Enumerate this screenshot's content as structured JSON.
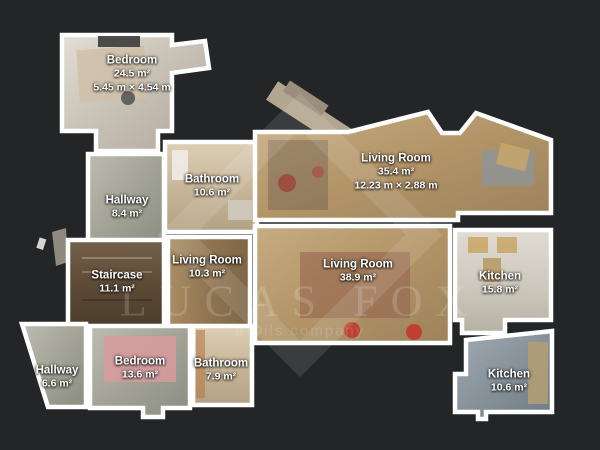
{
  "colors": {
    "background": "#232527",
    "wall": "#ffffff",
    "label_text": "#ffffff"
  },
  "watermark": {
    "brand": "LUCAS FOX",
    "tagline": "a Dils company"
  },
  "rooms": [
    {
      "id": "bedroom-top-left",
      "name": "Bedroom",
      "area": "24.5 m²",
      "dimensions": "5.45 m × 4.54 m"
    },
    {
      "id": "bathroom-upper",
      "name": "Bathroom",
      "area": "10.6 m²"
    },
    {
      "id": "living-room-top",
      "name": "Living Room",
      "area": "35.4 m²",
      "dimensions": "12.23 m × 2.88 m"
    },
    {
      "id": "hallway-upper",
      "name": "Hallway",
      "area": "8.4 m²"
    },
    {
      "id": "staircase",
      "name": "Staircase",
      "area": "11.1 m²"
    },
    {
      "id": "living-room-small",
      "name": "Living Room",
      "area": "10.3 m²"
    },
    {
      "id": "living-room-main",
      "name": "Living Room",
      "area": "38.9 m²"
    },
    {
      "id": "kitchen-main",
      "name": "Kitchen",
      "area": "15.8 m²"
    },
    {
      "id": "hallway-lower",
      "name": "Hallway",
      "area": "6.6 m²"
    },
    {
      "id": "bedroom-lower",
      "name": "Bedroom",
      "area": "13.6 m²"
    },
    {
      "id": "bathroom-lower",
      "name": "Bathroom",
      "area": "7.9 m²"
    },
    {
      "id": "kitchen-small",
      "name": "Kitchen",
      "area": "10.6 m²"
    }
  ]
}
